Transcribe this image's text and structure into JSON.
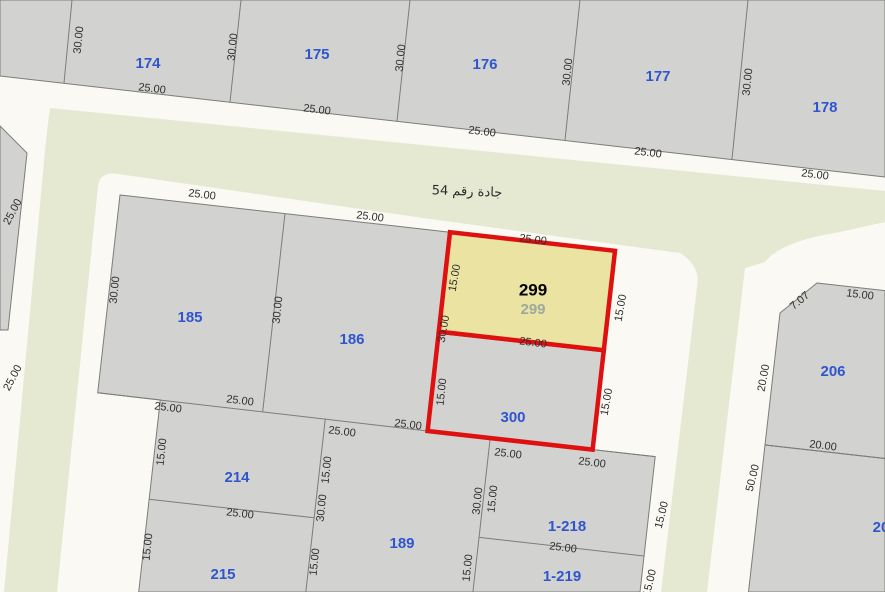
{
  "canvas": {
    "width": 885,
    "height": 592
  },
  "colors": {
    "background": "#faf9f3",
    "street_fill": "#e6e9d2",
    "parcel_fill": "#d2d2d0",
    "parcel_stroke": "#7c7c78",
    "highlight_fill": "#eae3a2",
    "highlight_stroke": "#df1010",
    "parcel_label": "#2f55cf",
    "dim_label": "#2e2e2e",
    "selected_label": "#000000",
    "selected_sub_label": "#9daa9b",
    "street_label": "#2b2b2b"
  },
  "map": {
    "street_name_label": {
      "text": "جادة رقم 54",
      "x": 467,
      "y": 192,
      "rot": 2,
      "size": 13
    },
    "streets": [
      {
        "name": "street-54-and-branch-roads",
        "path": "M 50,108 L 885,191 L 885,222 L 835,233 Q 780,242 765,262 L 745,268 L 707,592 L 661,592 L 697,287 Q 701,266 680,253 L 672,252 L 430,219 L 118,174 Q 100,171 98,186 L 57,592 L 4,592 L 46,140 Q 49,115 50,108 Z"
      }
    ],
    "blocks": [
      {
        "name": "block-north-row",
        "points": [
          [
            0,
            0
          ],
          [
            885,
            0
          ],
          [
            885,
            177
          ],
          [
            0,
            76
          ]
        ]
      },
      {
        "name": "parcel-west-edge",
        "points": [
          [
            0,
            126
          ],
          [
            27,
            153
          ],
          [
            8,
            330
          ],
          [
            0,
            330
          ]
        ]
      },
      {
        "name": "block-center",
        "points": [
          [
            120,
            195
          ],
          [
            450,
            232.2
          ],
          [
            615,
            250.8
          ],
          [
            592.6,
            449.6
          ],
          [
            655.2,
            456.6
          ],
          [
            640,
            592
          ],
          [
            138.7,
            592
          ],
          [
            160.3,
            399.9
          ],
          [
            97.7,
            392.8
          ]
        ]
      },
      {
        "name": "parcel-206-shape",
        "points": [
          [
            817,
            283
          ],
          [
            885,
            290.6
          ],
          [
            885,
            458.5
          ],
          [
            765,
            445
          ],
          [
            780,
            313
          ]
        ]
      },
      {
        "name": "parcel-south-of-206",
        "points": [
          [
            765,
            445
          ],
          [
            885,
            458.5
          ],
          [
            885,
            592
          ],
          [
            748.5,
            592
          ]
        ]
      }
    ],
    "inner_lines": [
      [
        [
          72,
          0
        ],
        [
          64,
          83
        ]
      ],
      [
        [
          241,
          0
        ],
        [
          230,
          102
        ]
      ],
      [
        [
          410,
          0
        ],
        [
          397,
          121
        ]
      ],
      [
        [
          580,
          0
        ],
        [
          565,
          140
        ]
      ],
      [
        [
          748,
          0
        ],
        [
          732,
          159
        ]
      ],
      [
        [
          285,
          213.6
        ],
        [
          262.7,
          411.4
        ]
      ],
      [
        [
          97.7,
          392.8
        ],
        [
          427.6,
          431
        ]
      ],
      [
        [
          149.1,
          499.3
        ],
        [
          314.1,
          517.8
        ]
      ],
      [
        [
          325.3,
          418.4
        ],
        [
          305.8,
          592
        ]
      ],
      [
        [
          490.2,
          438
        ],
        [
          472.9,
          592
        ]
      ],
      [
        [
          479,
          537.4
        ],
        [
          644,
          556
        ]
      ],
      [
        [
          592.6,
          449.6
        ],
        [
          655.2,
          456.6
        ]
      ],
      [
        [
          765,
          445
        ],
        [
          885,
          458.5
        ]
      ]
    ],
    "highlight": {
      "parcel_300": {
        "name": "parcel-300-boundary",
        "points": [
          [
            438.8,
            331.6
          ],
          [
            603.8,
            350.2
          ],
          [
            592.6,
            449.6
          ],
          [
            427.6,
            431
          ]
        ]
      },
      "parcel_299": {
        "name": "parcel-299-selected",
        "points": [
          [
            450,
            232.2
          ],
          [
            615,
            250.8
          ],
          [
            603.8,
            350.2
          ],
          [
            438.8,
            331.6
          ]
        ]
      }
    },
    "selected_labels": [
      {
        "text": "299",
        "x": 533,
        "y": 291,
        "size": 17,
        "bold": true,
        "which": "primary"
      },
      {
        "text": "299",
        "x": 533,
        "y": 310,
        "size": 15,
        "bold": true,
        "which": "secondary"
      }
    ],
    "parcel_labels": [
      {
        "text": "174",
        "x": 148,
        "y": 64
      },
      {
        "text": "175",
        "x": 317,
        "y": 55
      },
      {
        "text": "176",
        "x": 485,
        "y": 65
      },
      {
        "text": "177",
        "x": 658,
        "y": 77
      },
      {
        "text": "178",
        "x": 825,
        "y": 108
      },
      {
        "text": "185",
        "x": 190,
        "y": 318
      },
      {
        "text": "186",
        "x": 352,
        "y": 340
      },
      {
        "text": "300",
        "x": 513,
        "y": 418
      },
      {
        "text": "214",
        "x": 237,
        "y": 478
      },
      {
        "text": "215",
        "x": 223,
        "y": 575
      },
      {
        "text": "189",
        "x": 402,
        "y": 544
      },
      {
        "text": "1-218",
        "x": 567,
        "y": 527
      },
      {
        "text": "1-219",
        "x": 562,
        "y": 577
      },
      {
        "text": "206",
        "x": 833,
        "y": 372
      },
      {
        "text": "20",
        "x": 881,
        "y": 528
      }
    ],
    "dim_labels": [
      {
        "text": "30.00",
        "x": 79,
        "y": 40,
        "r": -84
      },
      {
        "text": "25.00",
        "x": 152,
        "y": 89,
        "r": 7
      },
      {
        "text": "30.00",
        "x": 233,
        "y": 47,
        "r": -84
      },
      {
        "text": "25.00",
        "x": 317,
        "y": 110,
        "r": 7
      },
      {
        "text": "30.00",
        "x": 401,
        "y": 58,
        "r": -84
      },
      {
        "text": "25.00",
        "x": 482,
        "y": 132,
        "r": 7
      },
      {
        "text": "30.00",
        "x": 568,
        "y": 72,
        "r": -84
      },
      {
        "text": "25.00",
        "x": 648,
        "y": 153,
        "r": 7
      },
      {
        "text": "30.00",
        "x": 748,
        "y": 82,
        "r": -84
      },
      {
        "text": "25.00",
        "x": 815,
        "y": 175,
        "r": 7
      },
      {
        "text": "25.00",
        "x": 13,
        "y": 212,
        "r": -62
      },
      {
        "text": "25.00",
        "x": 13,
        "y": 378,
        "r": -62
      },
      {
        "text": "30.00",
        "x": 115,
        "y": 290,
        "r": -84
      },
      {
        "text": "25.00",
        "x": 202,
        "y": 195,
        "r": 7
      },
      {
        "text": "25.00",
        "x": 370,
        "y": 217,
        "r": 7
      },
      {
        "text": "30.00",
        "x": 278,
        "y": 310,
        "r": -84
      },
      {
        "text": "25.00",
        "x": 240,
        "y": 401,
        "r": 7
      },
      {
        "text": "25.00",
        "x": 168,
        "y": 408,
        "r": 7
      },
      {
        "text": "25.00",
        "x": 342,
        "y": 432,
        "r": 7
      },
      {
        "text": "25.00",
        "x": 408,
        "y": 425,
        "r": 7
      },
      {
        "text": "15.00",
        "x": 162,
        "y": 452,
        "r": -84
      },
      {
        "text": "25.00",
        "x": 240,
        "y": 514,
        "r": 7
      },
      {
        "text": "15.00",
        "x": 148,
        "y": 547,
        "r": -84
      },
      {
        "text": "15.00",
        "x": 327,
        "y": 470,
        "r": -84
      },
      {
        "text": "30.00",
        "x": 322,
        "y": 508,
        "r": -84
      },
      {
        "text": "15.00",
        "x": 315,
        "y": 562,
        "r": -84
      },
      {
        "text": "25.00",
        "x": 533,
        "y": 240,
        "r": 7
      },
      {
        "text": "15.00",
        "x": 455,
        "y": 278,
        "r": -80
      },
      {
        "text": "15.00",
        "x": 621,
        "y": 308,
        "r": -80
      },
      {
        "text": "25.00",
        "x": 533,
        "y": 343,
        "r": 7
      },
      {
        "text": "30.00",
        "x": 444,
        "y": 329,
        "r": -80
      },
      {
        "text": "15.00",
        "x": 442,
        "y": 392,
        "r": -84
      },
      {
        "text": "15.00",
        "x": 607,
        "y": 402,
        "r": -80
      },
      {
        "text": "25.00",
        "x": 508,
        "y": 454,
        "r": 7
      },
      {
        "text": "25.00",
        "x": 592,
        "y": 463,
        "r": 7
      },
      {
        "text": "30.00",
        "x": 478,
        "y": 501,
        "r": -84
      },
      {
        "text": "15.00",
        "x": 493,
        "y": 499,
        "r": -84
      },
      {
        "text": "15.00",
        "x": 468,
        "y": 568,
        "r": -84
      },
      {
        "text": "25.00",
        "x": 563,
        "y": 548,
        "r": 7
      },
      {
        "text": "7.07",
        "x": 800,
        "y": 301,
        "r": -40
      },
      {
        "text": "15.00",
        "x": 860,
        "y": 295,
        "r": 7
      },
      {
        "text": "20.00",
        "x": 764,
        "y": 378,
        "r": -80
      },
      {
        "text": "20.00",
        "x": 823,
        "y": 446,
        "r": 7
      },
      {
        "text": "50.00",
        "x": 753,
        "y": 478,
        "r": -76
      },
      {
        "text": "15.00",
        "x": 662,
        "y": 515,
        "r": -76
      },
      {
        "text": "15.00",
        "x": 650,
        "y": 583,
        "r": -76
      }
    ]
  }
}
